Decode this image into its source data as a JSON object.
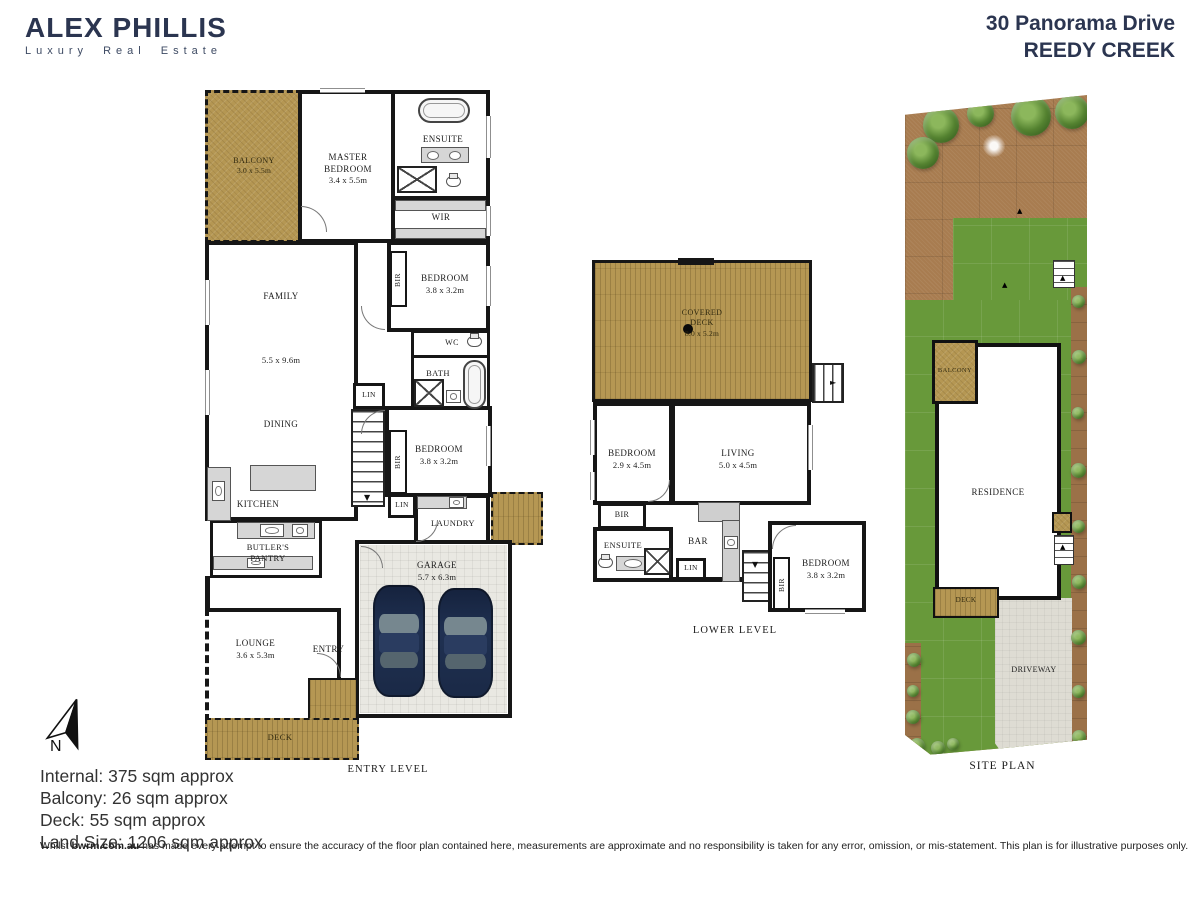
{
  "header": {
    "brand": "ALEX PHILLIS",
    "tagline": "Luxury Real Estate",
    "address_line1": "30 Panorama Drive",
    "address_line2": "REEDY CREEK"
  },
  "entry_level": {
    "caption": "ENTRY LEVEL",
    "balcony_label": "BALCONY",
    "balcony_dims": "3.0 x 5.5m",
    "master_label": "MASTER BEDROOM",
    "master_dims": "3.4 x 5.5m",
    "ensuite_label": "ENSUITE",
    "wir_label": "WIR",
    "bir_label": "BIR",
    "bedroom1_label": "BEDROOM",
    "bedroom1_dims": "3.8 x 3.2m",
    "wc_label": "WC",
    "bath_label": "BATH",
    "family_label": "FAMILY",
    "family_dims": "5.5 x 9.6m",
    "dining_label": "DINING",
    "kitchen_label": "KITCHEN",
    "butlers_label": "BUTLER'S PANTRY",
    "lin_label": "LIN",
    "bedroom2_label": "BEDROOM",
    "bedroom2_dims": "3.8 x 3.2m",
    "laundry_label": "LAUNDRY",
    "garage_label": "GARAGE",
    "garage_dims": "5.7 x 6.3m",
    "lounge_label": "LOUNGE",
    "lounge_dims": "3.6 x 5.3m",
    "entry_label": "ENTRY",
    "deck_label": "DECK"
  },
  "lower_level": {
    "caption": "LOWER LEVEL",
    "covered_deck_line1": "COVERED",
    "covered_deck_line2": "DECK",
    "covered_deck_dims": "8.0 x 5.2m",
    "bedroom3_label": "BEDROOM",
    "bedroom3_dims": "2.9 x 4.5m",
    "living_label": "LIVING",
    "living_dims": "5.0 x 4.5m",
    "bir_label": "BIR",
    "ensuite_label": "ENSUITE",
    "bar_label": "BAR",
    "lin_label": "LIN",
    "bedroom4_label": "BEDROOM",
    "bedroom4_dims": "3.8 x 3.2m"
  },
  "site_plan": {
    "caption": "SITE PLAN",
    "balcony_label": "BALCONY",
    "residence_label": "RESIDENCE",
    "deck_label": "DECK",
    "driveway_label": "DRIVEWAY"
  },
  "compass": {
    "north_label": "N"
  },
  "areas": {
    "internal": "Internal: 375 sqm approx",
    "balcony": "Balcony: 26 sqm approx",
    "deck": "Deck: 55 sqm approx",
    "land_size": "Land Size: 1206 sqm approx"
  },
  "disclaimer": {
    "prefix": "Whilst ",
    "brand": "bwrm.com.au",
    "suffix": " has made every attempt to ensure the accuracy of the floor plan contained here, measurements are approximate and no responsibility is taken for any error, omission, or mis-statement. This plan is for illustrative purposes only."
  },
  "colors": {
    "brand_navy": "#2b3550",
    "deck_tan": "#b59753",
    "dirt_brown": "#a87c50",
    "lawn_green": "#68993a",
    "driveway_gray": "#dedcd3",
    "wall": "#161616"
  }
}
